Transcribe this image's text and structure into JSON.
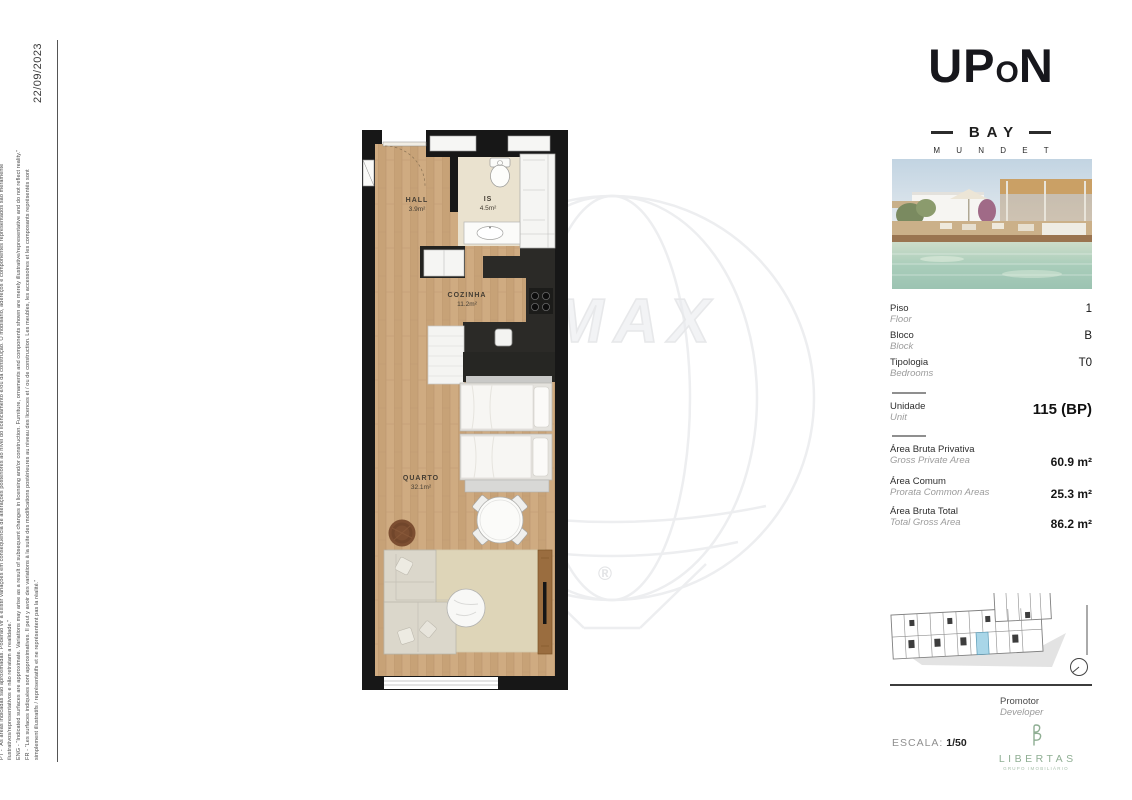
{
  "page": {
    "date": "22/09/2023",
    "disclaimer_lines": [
      "PT - “As áreas indicadas são aproximadas. Poderão vir a existir variações em consequência de alterações posteriores ao nível do licenciamento e/ou da construção. O mobiliário, adereços e componentes representados são meramente",
      "ilustrativos/representativos e não retratam a realidade.”",
      "ENG - “Indicated surfaces are approximate. Variations may arise as a result of subsequent changes in licensing and/or construction. Furniture, ornaments and components shown are merely illustrative/representative and do not reflect reality.”",
      "FR - “Les surfaces indiquées sont approximatives. Il peut y avoir des variations à la suite des modifications postérieures au niveau des licences et / ou de construction. Les meubles, les accessoires et les composants représentés sont",
      "simplement illustratifs / représentatifs et ne représentent pas la réalité.”"
    ]
  },
  "brand": {
    "up": "UP",
    "o": "O",
    "n": "N",
    "bay": "BAY",
    "tagline": "M U N D E T"
  },
  "watermark": {
    "text": "MAX",
    "registered": "®"
  },
  "floorplan": {
    "rooms": [
      {
        "name": "HALL",
        "area": "3.9m²"
      },
      {
        "name": "IS",
        "area": "4.5m²"
      },
      {
        "name": "COZINHA",
        "area": "11.2m²"
      },
      {
        "name": "QUARTO",
        "area": "32.1m²"
      }
    ]
  },
  "details": {
    "rows": [
      {
        "label": "Piso",
        "sublabel": "Floor",
        "value": "1"
      },
      {
        "label": "Bloco",
        "sublabel": "Block",
        "value": "B"
      },
      {
        "label": "Tipologia",
        "sublabel": "Bedrooms",
        "value": "T0"
      }
    ],
    "unit": {
      "label": "Unidade",
      "sublabel": "Unit",
      "value": "115 (BP)"
    },
    "areas": [
      {
        "label": "Área Bruta Privativa",
        "sublabel": "Gross Private Area",
        "value": "60.9 m²"
      },
      {
        "label": "Área Comum",
        "sublabel": "Prorata Common Areas",
        "value": "25.3 m²"
      },
      {
        "label": "Área Bruta Total",
        "sublabel": "Total Gross Area",
        "value": "86.2 m²"
      }
    ]
  },
  "footer": {
    "promoter_label": "Promotor",
    "promoter_sublabel": "Developer",
    "scale_label": "ESCALA:",
    "scale_value": "1/50",
    "developer_name": "LIBERTAS",
    "developer_tagline": "GRUPO IMOBILIÁRIO"
  },
  "colors": {
    "wall_black": "#171717",
    "wood_floor": "#cba77d",
    "bathroom_floor": "#eae2cf",
    "highlight_unit_blue": "#a9d6e8",
    "libertas_green": "#8fae93",
    "watermark_gray": "#ececee"
  }
}
